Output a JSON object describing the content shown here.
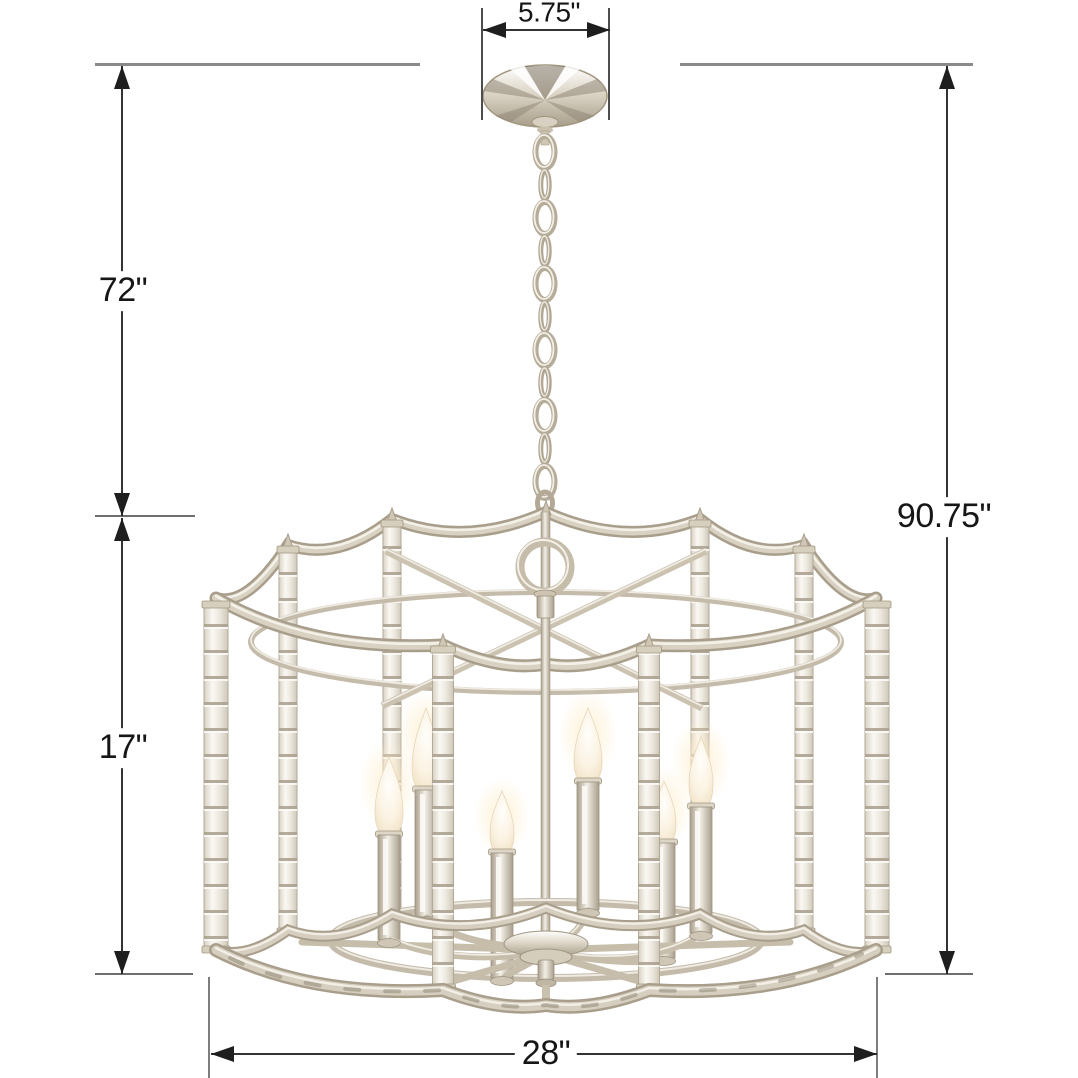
{
  "page": {
    "background": "#ffffff"
  },
  "product": {
    "name": "crystal and polished nickel 6-light drum chandelier",
    "lights_count": 6,
    "metal_color": "#cfc6b4",
    "crystal_color": "#f2efe8",
    "bulb_color": "#fbf3e3"
  },
  "annotation": {
    "line_color": "#2f2f2f",
    "guide_color": "#8a8a8a",
    "label_color": "#161616"
  },
  "dimensions": {
    "canopy_width_in": "5.75\"",
    "chain_drop_in": "72\"",
    "overall_height_in": "90.75\"",
    "body_height_in": "17\"",
    "body_width_in": "28\""
  }
}
